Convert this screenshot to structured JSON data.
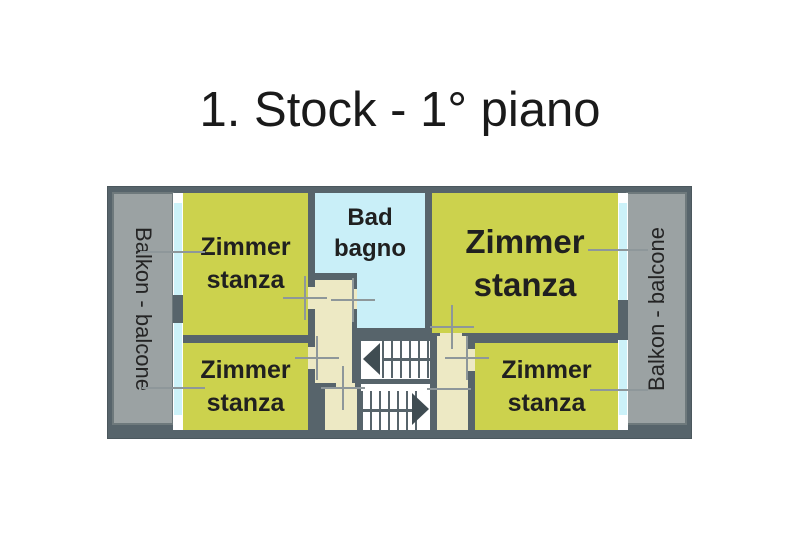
{
  "title": "1. Stock - 1° piano",
  "floorplan": {
    "balcony_left_label": "Balkon - balcone",
    "balcony_right_label": "Balkon - balcone",
    "bathroom": {
      "line1": "Bad",
      "line2": "bagno"
    },
    "rooms": [
      {
        "id": "room-top-left",
        "line1": "Zimmer",
        "line2": "stanza"
      },
      {
        "id": "room-bottom-left",
        "line1": "Zimmer",
        "line2": "stanza"
      },
      {
        "id": "room-top-right",
        "line1": "Zimmer",
        "line2": "stanza"
      },
      {
        "id": "room-bottom-right",
        "line1": "Zimmer",
        "line2": "stanza"
      }
    ],
    "stairs": {
      "up_arrow_icon": "triangle-left",
      "down_arrow_icon": "triangle-right"
    }
  },
  "colors": {
    "wall": "#57646b",
    "room_green": "#ccd24d",
    "bathroom_cyan": "#c9eff8",
    "corridor_cream": "#ede9c4",
    "balcony_gray": "#9ba2a3",
    "window_cyan": "#ccf2f9",
    "door_mark_gray": "#8e979a",
    "stair_white": "#ffffff",
    "text_black": "#1a1a1a",
    "background": "#ffffff"
  }
}
